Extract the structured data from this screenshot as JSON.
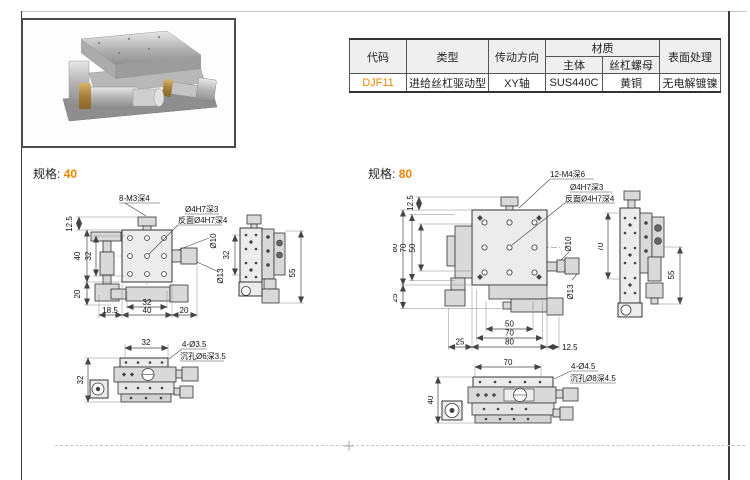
{
  "accent": "#f08300",
  "table": {
    "headers": {
      "code": "代码",
      "type": "类型",
      "direction": "传动方向",
      "material": "材质",
      "body": "主体",
      "nut": "丝杠螺母",
      "surface": "表面处理"
    },
    "row": {
      "code": "DJF11",
      "type": "进给丝杠驱动型",
      "direction": "XY轴",
      "body": "SUS440C",
      "nut": "黄铜",
      "surface": "无电解镀镍"
    }
  },
  "spec40": {
    "label": "规格:",
    "size": "40",
    "plan": {
      "callout_thread": "8-M3深4",
      "callout_hole": "Ø4H7深3",
      "callout_hole_back": "反面Ø4H7深4",
      "dim_top_offset": "12.5",
      "dim_height": "40",
      "dim_hole_span_v": "32",
      "dim_bottom_offset": "20",
      "dim_left_offset": "18.5",
      "dim_hole_span_h": "32",
      "dim_width": "40",
      "dim_right_offset": "20",
      "dia_shaft": "Ø10",
      "dia_knob": "Ø13"
    },
    "side": {
      "dim_span": "32",
      "dim_height": "55"
    },
    "bottom": {
      "dim_width": "32",
      "dim_height": "32",
      "callout_holes": "4-Ø3.5",
      "callout_cbore": "沉孔Ø6深3.5"
    }
  },
  "spec80": {
    "label": "规格:",
    "size": "80",
    "plan": {
      "callout_thread": "12-M4深6",
      "callout_hole": "Ø4H7深3",
      "callout_hole_back": "反面Ø4H7深4",
      "dim_top_offset": "12.5",
      "dim_height": "80",
      "dim_hole_span_v": "70",
      "dim_hole_inner_v": "50",
      "dim_bottom_offset": "25",
      "dim_left_offset": "25",
      "dim_hole_inner_h": "50",
      "dim_hole_span_h": "70",
      "dim_width": "80",
      "dim_right_offset": "12.5",
      "dia_shaft": "Ø10",
      "dia_knob": "Ø13"
    },
    "side": {
      "dim_span": "70",
      "dim_height": "55"
    },
    "bottom": {
      "dim_width": "70",
      "dim_height": "40",
      "callout_holes": "4-Ø4.5",
      "callout_cbore": "沉孔Ø8深4.5"
    }
  }
}
